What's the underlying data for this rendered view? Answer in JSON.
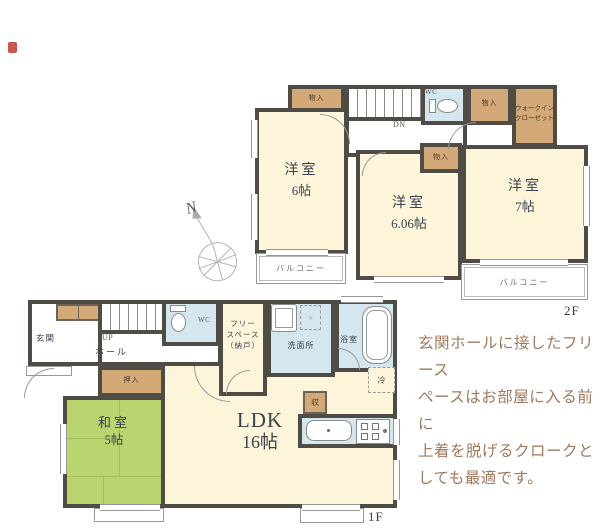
{
  "colors": {
    "wall": "#4f4b45",
    "room_cream": "#fcf5da",
    "closet_brown": "#d3a977",
    "wet_blue": "#d4e7ee",
    "tatami_green": "#bad56f",
    "label_dark": "#3a4150",
    "annotation_brown": "#a3795c"
  },
  "floor2": {
    "floor_label": "2F",
    "room_a": {
      "name": "洋室",
      "size": "6帖"
    },
    "room_b": {
      "name": "洋室",
      "size": "6.06帖"
    },
    "room_c": {
      "name": "洋室",
      "size": "7帖"
    },
    "closet_top": {
      "label": "物入"
    },
    "closet_mid": {
      "label": "物入"
    },
    "closet_b": {
      "label": "物入"
    },
    "wic": {
      "line1": "ウォークイン",
      "line2": "クローゼット"
    },
    "wc": {
      "label": "WC"
    },
    "stairs": {
      "label": "DN"
    },
    "balcony_left": {
      "label": "バルコニー"
    },
    "balcony_right": {
      "label": "バルコニー"
    }
  },
  "floor1": {
    "floor_label": "1F",
    "genkan": {
      "label": "玄関"
    },
    "hall": {
      "label": "ホール"
    },
    "stairs": {
      "label": "UP"
    },
    "wc": {
      "label": "WC"
    },
    "free_space": {
      "line1": "フリー",
      "line2": "スペース",
      "line3": "（納戸）"
    },
    "washroom": {
      "label": "洗面所"
    },
    "bath": {
      "label": "浴室"
    },
    "ldk": {
      "name": "LDK",
      "size": "16帖"
    },
    "washitsu": {
      "name": "和室",
      "size": "5帖"
    },
    "oshiire": {
      "label": "押入"
    },
    "storage": {
      "label": "収"
    },
    "fridge": {
      "label": "冷"
    }
  },
  "compass": {
    "north": "N"
  },
  "annotation": {
    "line1": "玄関ホールに接したフリース",
    "line2": "ペースはお部屋に入る前に",
    "line3": "上着を脱げるクロークと",
    "line4": "しても最適です。"
  }
}
